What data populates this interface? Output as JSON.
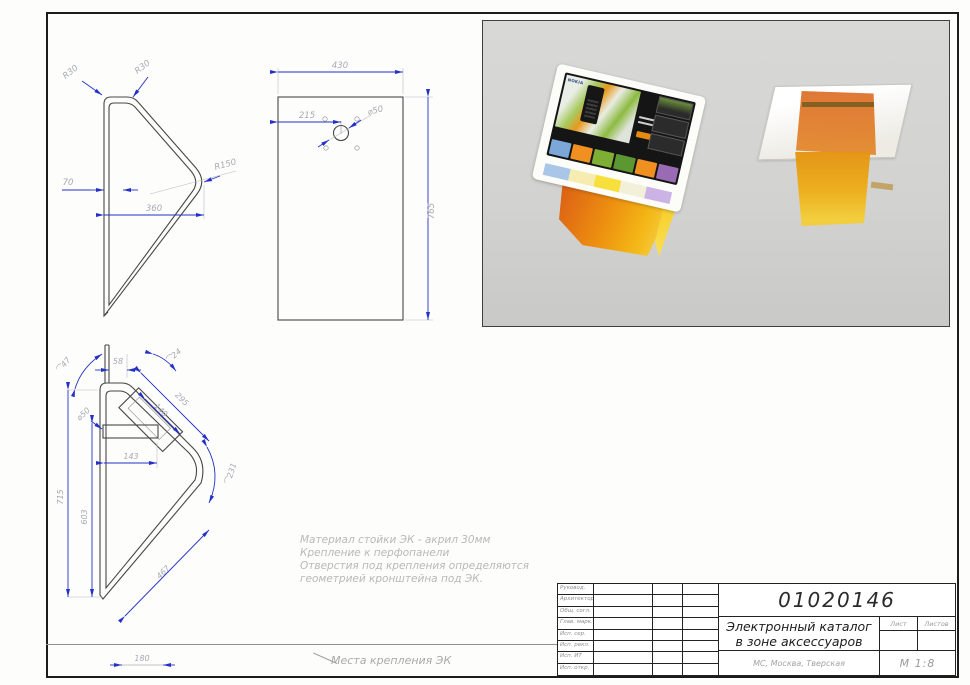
{
  "dims": {
    "side_top": {
      "r30a": "R30",
      "r30b": "R30",
      "r150": "R150",
      "t70": "70",
      "w360": "360"
    },
    "front": {
      "w430": "430",
      "h765": "765",
      "c215": "215",
      "d50": "⌀50"
    },
    "side_bottom": {
      "a47": "⌒47",
      "t58": "58",
      "a24": "⌒24",
      "l295": "295",
      "l140": "140",
      "d50": "⌀50",
      "w143": "143",
      "a231": "⌒231",
      "h715": "715",
      "h603": "603",
      "l467": "467",
      "s180": "180"
    }
  },
  "notes": {
    "l1": "Материал стойки ЭК - акрил 30мм",
    "l2": "Крепление к перфопанели",
    "l3": "Отверстия под крепления определяются",
    "l4": "геометрией кронштейна под ЭК.",
    "mount_callout": "Места крепления ЭК"
  },
  "render": {
    "brand": "NOKIA"
  },
  "titleblock": {
    "doc_number": "01020146",
    "title1": "Электронный каталог",
    "title2": "в зоне аксессуаров",
    "location": "МС, Москва, Тверская",
    "scale": "М 1:8",
    "col_sheet": "Лист",
    "col_sheets": "Листов",
    "signoff_rows": [
      "Руковод.",
      "Архитектор",
      "Общ. согл.",
      "Глав. марк.",
      "Исп. сер.",
      "Исп. рекл.",
      "Исп. ИТ",
      "Исп. откр."
    ]
  }
}
